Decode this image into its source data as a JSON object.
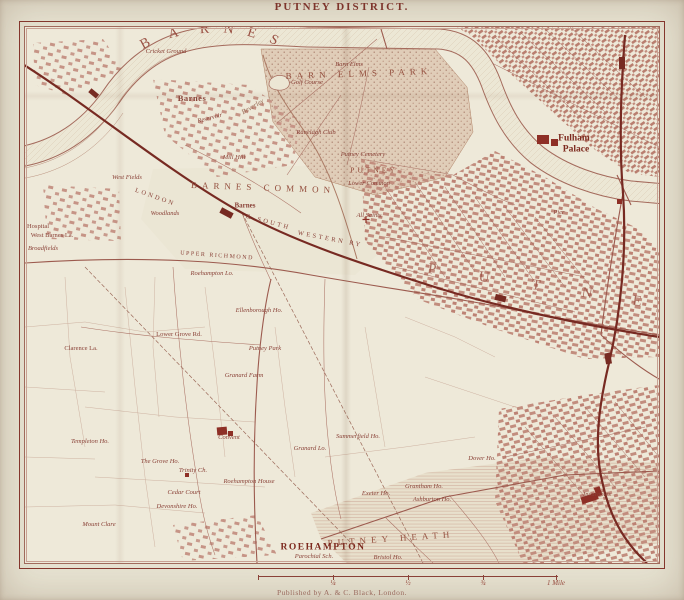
{
  "page": {
    "title": "PUTNEY DISTRICT.",
    "publisher": "Published by A. & C. Black, London."
  },
  "colors": {
    "paper": "#e7e3d2",
    "map_paper": "#eee9d9",
    "ink": "#8a4238",
    "railway": "#772a22",
    "landmark": "#8e2f26",
    "urban_block": "#c28d7e",
    "park_stipple": "#a97f6d"
  },
  "scale_bar": {
    "marks": [
      {
        "x": 0,
        "label": ""
      },
      {
        "x": 75,
        "label": "¼"
      },
      {
        "x": 150,
        "label": "½"
      },
      {
        "x": 225,
        "label": "¾"
      },
      {
        "x": 298,
        "label": "1 Mile"
      }
    ]
  },
  "map": {
    "labels": [
      {
        "t": "B",
        "x": 121,
        "y": 17,
        "s": "dl",
        "r": -28
      },
      {
        "t": "A",
        "x": 149,
        "y": 7,
        "s": "dl",
        "r": -14
      },
      {
        "t": "R",
        "x": 180,
        "y": 3,
        "s": "dl",
        "r": -3
      },
      {
        "t": "N",
        "x": 204,
        "y": 3,
        "s": "dl",
        "r": 8
      },
      {
        "t": "E",
        "x": 227,
        "y": 7,
        "s": "dl",
        "r": 18
      },
      {
        "t": "S",
        "x": 249,
        "y": 14,
        "s": "dl",
        "r": 28
      },
      {
        "t": "P",
        "x": 407,
        "y": 243,
        "s": "dl2",
        "r": 8
      },
      {
        "t": "U",
        "x": 459,
        "y": 251,
        "s": "dl2",
        "r": 8
      },
      {
        "t": "T",
        "x": 511,
        "y": 259,
        "s": "dl2",
        "r": 8
      },
      {
        "t": "N",
        "x": 562,
        "y": 267,
        "s": "dl2",
        "r": 8
      },
      {
        "t": "E",
        "x": 612,
        "y": 275,
        "s": "dl2",
        "r": 8
      },
      {
        "t": "BARN ELMS PARK",
        "x": 334,
        "y": 47,
        "s": "area",
        "r": -2
      },
      {
        "t": "BARNES COMMON",
        "x": 238,
        "y": 161,
        "s": "area",
        "r": 2
      },
      {
        "t": "PUTNEY HEATH",
        "x": 366,
        "y": 512,
        "s": "area",
        "r": -4
      },
      {
        "t": "PUTNEY",
        "x": 349,
        "y": 143,
        "s": "area2",
        "r": 0
      },
      {
        "t": "Lower Common",
        "x": 344,
        "y": 157,
        "s": "sm",
        "r": 0
      },
      {
        "t": "Barnes",
        "x": 167,
        "y": 71,
        "s": "town",
        "r": 0
      },
      {
        "t": "ROEHAMPTON",
        "x": 298,
        "y": 521,
        "s": "townbig",
        "r": 0
      },
      {
        "t": "Fulham",
        "x": 549,
        "y": 112,
        "s": "palace",
        "r": 0
      },
      {
        "t": "Palace",
        "x": 551,
        "y": 123,
        "s": "palace",
        "r": 0
      },
      {
        "t": "Barnes",
        "x": 220,
        "y": 179,
        "s": "stn",
        "r": 0
      },
      {
        "t": "LONDON",
        "x": 130,
        "y": 171,
        "s": "rail",
        "r": 20
      },
      {
        "t": "& SOUTH",
        "x": 243,
        "y": 196,
        "s": "rail",
        "r": 15
      },
      {
        "t": "WESTERN RY",
        "x": 305,
        "y": 213,
        "s": "rail",
        "r": 11
      },
      {
        "t": "UPPER RICHMOND",
        "x": 192,
        "y": 229,
        "s": "road",
        "r": 4
      },
      {
        "t": "Cricket Ground",
        "x": 141,
        "y": 25,
        "s": "sm",
        "r": 0
      },
      {
        "t": "Barn Elms",
        "x": 324,
        "y": 38,
        "s": "sm",
        "r": 0
      },
      {
        "t": "Golf Course",
        "x": 282,
        "y": 56,
        "s": "sm",
        "r": 0
      },
      {
        "t": "Ranelagh Club",
        "x": 291,
        "y": 106,
        "s": "sm",
        "r": 0
      },
      {
        "t": "Reservoir",
        "x": 185,
        "y": 92,
        "s": "sm",
        "r": -15
      },
      {
        "t": "Beverley",
        "x": 228,
        "y": 80,
        "s": "water",
        "r": -30
      },
      {
        "t": "Mill Hill",
        "x": 209,
        "y": 131,
        "s": "sm",
        "r": 0
      },
      {
        "t": "West Fields",
        "x": 102,
        "y": 151,
        "s": "sm",
        "r": 0
      },
      {
        "t": "Woodlands",
        "x": 140,
        "y": 187,
        "s": "sm",
        "r": 0
      },
      {
        "t": "Hospital",
        "x": 13,
        "y": 200,
        "s": "pl",
        "r": 0
      },
      {
        "t": "West Barnes La.",
        "x": 27,
        "y": 209,
        "s": "pl",
        "r": 0
      },
      {
        "t": "Broadfields",
        "x": 18,
        "y": 222,
        "s": "sm",
        "r": 0
      },
      {
        "t": "Roehampton Lo.",
        "x": 187,
        "y": 247,
        "s": "sm",
        "r": 0
      },
      {
        "t": "Ellenborough Ho.",
        "x": 234,
        "y": 284,
        "s": "sm",
        "r": 0
      },
      {
        "t": "Lower Grove Rd.",
        "x": 154,
        "y": 308,
        "s": "pl",
        "r": 0
      },
      {
        "t": "Clarence La.",
        "x": 56,
        "y": 322,
        "s": "pl",
        "r": 0
      },
      {
        "t": "Putney Park",
        "x": 240,
        "y": 322,
        "s": "sm",
        "r": 0
      },
      {
        "t": "Granard Farm",
        "x": 219,
        "y": 349,
        "s": "sm",
        "r": 0
      },
      {
        "t": "Summerfield Ho.",
        "x": 333,
        "y": 410,
        "s": "sm",
        "r": 0
      },
      {
        "t": "Granard Lo.",
        "x": 285,
        "y": 422,
        "s": "sm",
        "r": 0
      },
      {
        "t": "Dover Ho.",
        "x": 457,
        "y": 432,
        "s": "sm",
        "r": 0
      },
      {
        "t": "Templeton Ho.",
        "x": 65,
        "y": 415,
        "s": "sm",
        "r": 0
      },
      {
        "t": "The Grove Ho.",
        "x": 135,
        "y": 435,
        "s": "sm",
        "r": 0
      },
      {
        "t": "Trinity Ch.",
        "x": 168,
        "y": 444,
        "s": "sm",
        "r": 0
      },
      {
        "t": "Convent",
        "x": 204,
        "y": 411,
        "s": "sm",
        "r": 0
      },
      {
        "t": "Roehampton House",
        "x": 224,
        "y": 455,
        "s": "sm",
        "r": 0
      },
      {
        "t": "Cedar Court",
        "x": 159,
        "y": 466,
        "s": "sm",
        "r": 0
      },
      {
        "t": "Devonshire Ho.",
        "x": 152,
        "y": 480,
        "s": "sm",
        "r": 0
      },
      {
        "t": "Mount Clare",
        "x": 74,
        "y": 498,
        "s": "sm",
        "r": 0
      },
      {
        "t": "Exeter Ho.",
        "x": 351,
        "y": 467,
        "s": "sm",
        "r": 0
      },
      {
        "t": "Grantham Ho.",
        "x": 399,
        "y": 460,
        "s": "sm",
        "r": 0
      },
      {
        "t": "Ashburton Ho.",
        "x": 407,
        "y": 473,
        "s": "sm",
        "r": 0
      },
      {
        "t": "Parochial Sch.",
        "x": 289,
        "y": 530,
        "s": "sm",
        "r": 0
      },
      {
        "t": "Bristol Ho.",
        "x": 363,
        "y": 531,
        "s": "sm",
        "r": 0
      },
      {
        "t": "Incurables",
        "x": 572,
        "y": 468,
        "s": "sm",
        "r": 0
      },
      {
        "t": "Pier",
        "x": 534,
        "y": 186,
        "s": "sm",
        "r": 0
      },
      {
        "t": "Putney Cemetery",
        "x": 338,
        "y": 128,
        "s": "sm",
        "r": 0
      },
      {
        "t": "All Saints",
        "x": 344,
        "y": 189,
        "s": "sm",
        "r": 0
      }
    ]
  }
}
